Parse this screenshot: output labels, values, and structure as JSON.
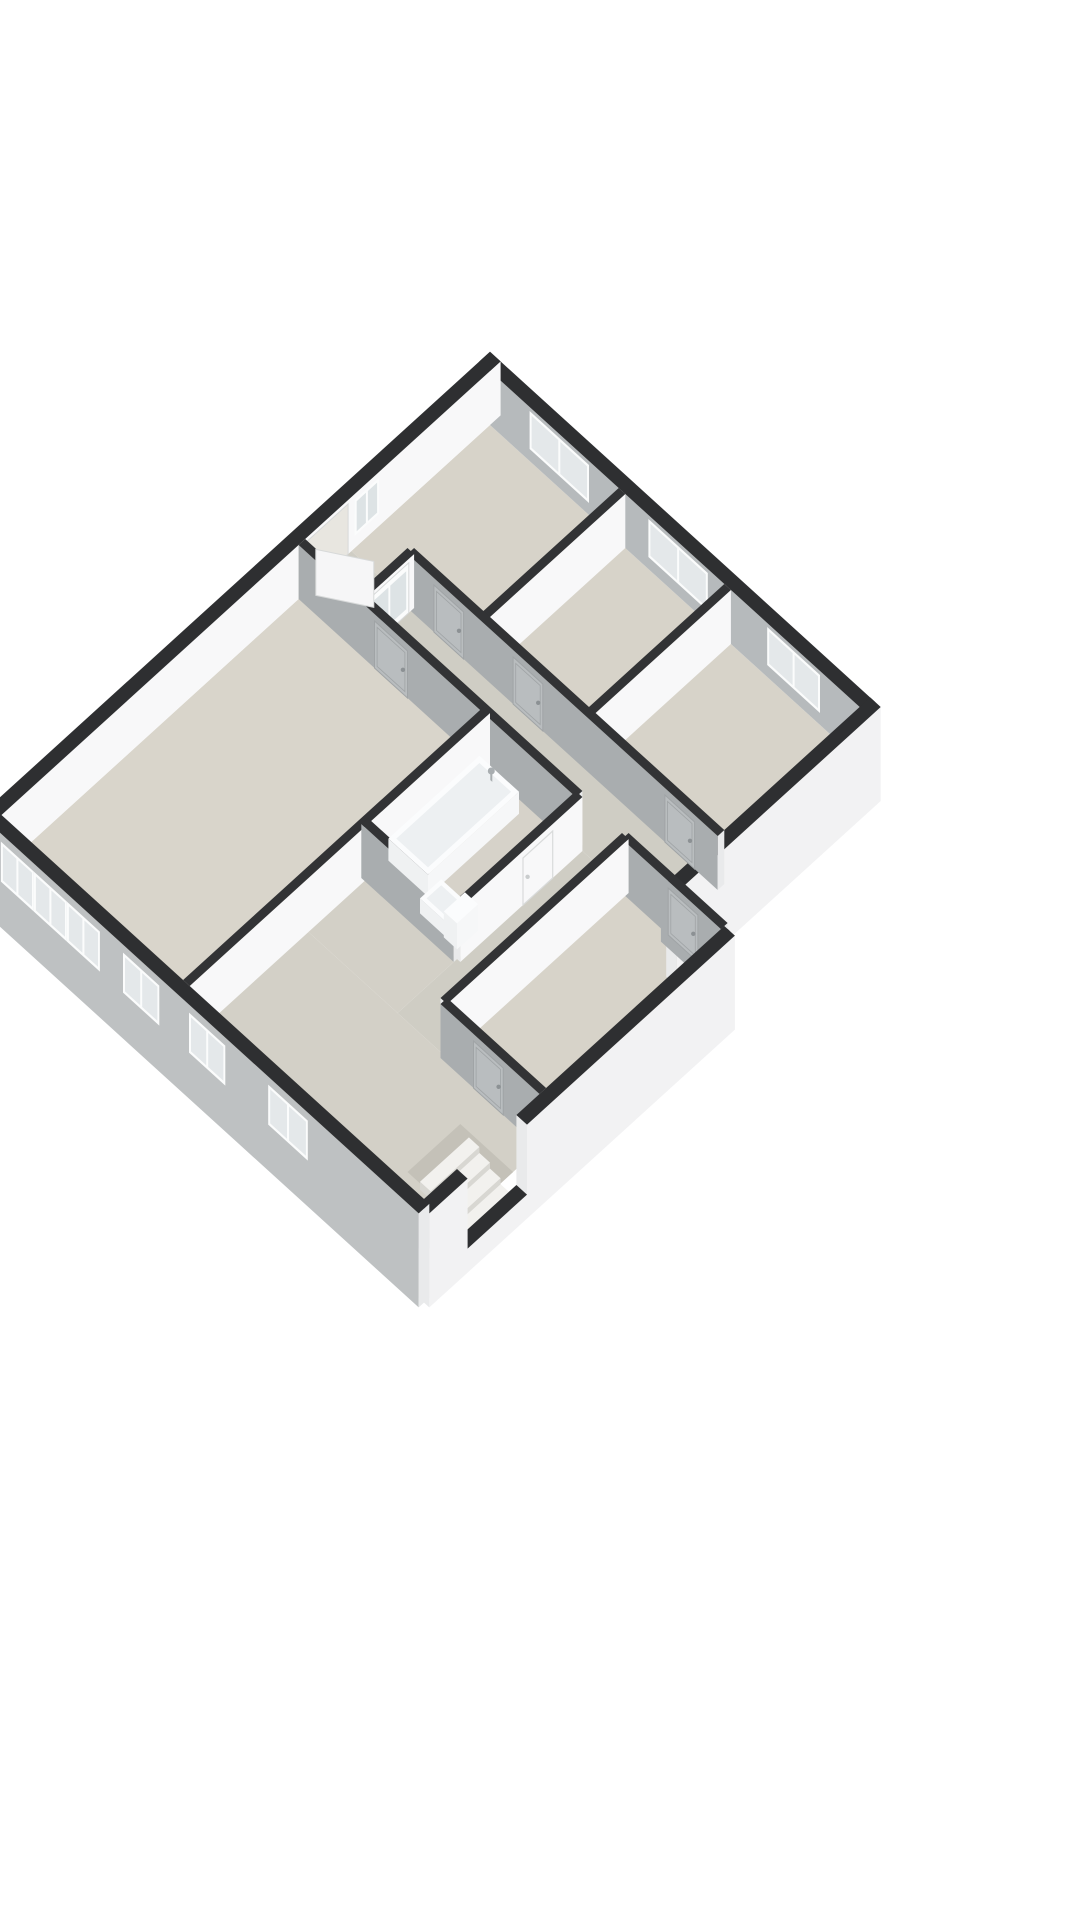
{
  "scene": {
    "proj": {
      "cx": 490,
      "cy": 425,
      "kx": 0.66,
      "ky": 0.6,
      "wallHeight": 54
    },
    "colors": {
      "bg": "#ffffff",
      "cap": "#2e2f31",
      "capInt": "#323335",
      "extWhite": "#f2f2f3",
      "extSW": "#bec1c2",
      "intWhite": "#f8f8f9",
      "intGray": "#b6babc",
      "intGrayDark": "#a9adaf",
      "endCap": "#e9eaeb",
      "floorRoom": "#d7d3c9",
      "floorLiving": "#d9d5cb",
      "floorCorridor": "#cfcdc4",
      "floorHall": "#d3d0c7",
      "floorBath": "#d6d2c9",
      "stairwell": "#c4c1b8",
      "tread": "#f2f1ee",
      "riser": "#d8d7d2",
      "frame": "#fbfcfc",
      "pane": "#e4e8ea",
      "paneDoor": "#dde3e5",
      "leaf": "#f6f6f7",
      "leafLine": "#d7d9d9",
      "outlineLine": "#d9dbdb",
      "doorGray": "#b9bdbf",
      "doorGrayLine": "#a0a4a6",
      "doorHandle": "#8c9194",
      "handleLight": "#c9cccd",
      "openingJamb": "#e8e6e0",
      "tubTop": "#fbfcfd",
      "tubBasin": "#edf0f2",
      "tubSide": "#eff1f2",
      "tubSideE": "#f6f7f8",
      "metal": "#a9aeb1"
    },
    "floors": [
      {
        "n": "bedroom-1-floor",
        "r": [
          0,
          0,
          200,
          210
        ],
        "c": "floorRoom"
      },
      {
        "n": "bedroom-2-floor",
        "r": [
          200,
          0,
          360,
          210
        ],
        "c": "floorRoom"
      },
      {
        "n": "bedroom-3-floor",
        "r": [
          360,
          0,
          560,
          210
        ],
        "c": "floorRoom"
      },
      {
        "n": "corridor-floor",
        "r": [
          0,
          210,
          560,
          285
        ],
        "c": "floorCorridor"
      },
      {
        "n": "corridor-2-floor",
        "r": [
          420,
          285,
          490,
          560
        ],
        "c": "floorCorridor"
      },
      {
        "n": "bathroom-floor",
        "r": [
          280,
          285,
          420,
          470
        ],
        "c": "floorBath"
      },
      {
        "n": "living-room-floor",
        "r": [
          0,
          285,
          280,
          740
        ],
        "c": "floorLiving"
      },
      {
        "n": "se-bedroom-floor",
        "r": [
          490,
          285,
          640,
          560
        ],
        "c": "floorRoom"
      },
      {
        "n": "hall-upper-floor",
        "r": [
          280,
          470,
          420,
          560
        ],
        "c": "floorHall"
      },
      {
        "n": "hall-floor",
        "r": [
          280,
          560,
          640,
          740
        ],
        "c": "floorHall"
      }
    ],
    "walls": [
      {
        "n": "exterior-wall-ne",
        "axis": "x",
        "at": -8,
        "f": -16,
        "t2": 568,
        "th": 16,
        "zb": 0,
        "c": "intGray",
        "capc": "cap",
        "feat": [
          {
            "k": "win",
            "a": 60,
            "b": 150,
            "s": 12,
            "t": 50
          },
          {
            "k": "win",
            "a": 240,
            "b": 330,
            "s": 12,
            "t": 50
          },
          {
            "k": "win",
            "a": 420,
            "b": 500,
            "s": 12,
            "t": 50
          }
        ]
      },
      {
        "n": "exterior-wall-nw",
        "axis": "y",
        "at": -8,
        "f": -16,
        "t2": 748,
        "th": 16,
        "zb": 0,
        "c": "intWhite",
        "capc": "cap",
        "feat": [
          {
            "k": "win",
            "a": 168,
            "b": 205,
            "s": 12,
            "t": 48,
            "pane": "paneDoor"
          },
          {
            "k": "opening",
            "a": 215,
            "b": 280
          }
        ]
      },
      {
        "n": "partition-bed1-bed2",
        "axis": "y",
        "at": 200,
        "f": 0,
        "t2": 210,
        "th": 10,
        "c": "intWhite",
        "capc": "capInt"
      },
      {
        "n": "partition-bed2-bed3",
        "axis": "y",
        "at": 360,
        "f": 0,
        "t2": 210,
        "th": 10,
        "c": "intWhite",
        "capc": "capInt"
      },
      {
        "n": "exterior-wall-se-upper",
        "axis": "y",
        "at": 568,
        "f": -16,
        "t2": 293,
        "th": 16,
        "zb": -40,
        "c": "extWhite",
        "capc": "cap"
      },
      {
        "n": "partition-corridor-north",
        "axis": "x",
        "at": 210,
        "f": 90,
        "t2": 560,
        "th": 10,
        "c": "intGrayDark",
        "capc": "capInt",
        "feat": [
          {
            "k": "door",
            "a": 130,
            "b": 175
          },
          {
            "k": "door",
            "a": 250,
            "b": 295
          },
          {
            "k": "door",
            "a": 480,
            "b": 525
          }
        ]
      },
      {
        "n": "exterior-wall-step",
        "axis": "x",
        "at": 293,
        "f": 560,
        "t2": 648,
        "th": 16,
        "zb": 0,
        "c": "intGrayDark",
        "capc": "cap"
      },
      {
        "n": "partition-vestibule",
        "axis": "y",
        "at": 90,
        "f": 210,
        "t2": 285,
        "th": 10,
        "c": "intWhite",
        "capc": "capInt",
        "feat": [
          {
            "k": "glass_door",
            "a": 218,
            "b": 277
          }
        ]
      },
      {
        "n": "partition-corridor-south",
        "axis": "x",
        "at": 285,
        "f": 0,
        "t2": 420,
        "th": 10,
        "c": "intGrayDark",
        "capc": "capInt",
        "feat": [
          {
            "k": "door",
            "a": 115,
            "b": 165
          }
        ]
      },
      {
        "n": "partition-sebed-north",
        "axis": "x",
        "at": 285,
        "f": 490,
        "t2": 640,
        "th": 10,
        "c": "intGrayDark",
        "capc": "capInt",
        "feat": [
          {
            "k": "door",
            "a": 560,
            "b": 605
          }
        ]
      },
      {
        "n": "partition-living-east",
        "axis": "y",
        "at": 280,
        "f": 285,
        "t2": 740,
        "th": 10,
        "c": "intWhite",
        "capc": "capInt"
      },
      {
        "n": "partition-bath-east",
        "axis": "y",
        "at": 420,
        "f": 285,
        "t2": 470,
        "th": 10,
        "c": "intWhite",
        "capc": "capInt",
        "feat": [
          {
            "k": "door_outline",
            "a": 330,
            "b": 375
          }
        ]
      },
      {
        "n": "partition-sebed-west",
        "axis": "y",
        "at": 490,
        "f": 285,
        "t2": 560,
        "th": 10,
        "c": "intWhite",
        "capc": "capInt"
      },
      {
        "n": "partition-bath-south",
        "axis": "x",
        "at": 470,
        "f": 280,
        "t2": 420,
        "th": 10,
        "c": "intGrayDark",
        "capc": "capInt"
      },
      {
        "n": "partition-sebed-south",
        "axis": "x",
        "at": 560,
        "f": 490,
        "t2": 640,
        "th": 10,
        "c": "intGrayDark",
        "capc": "capInt",
        "feat": [
          {
            "k": "door",
            "a": 540,
            "b": 585
          }
        ]
      },
      {
        "n": "exterior-wall-se-lower-a",
        "axis": "y",
        "at": 648,
        "f": 285,
        "t2": 600,
        "th": 16,
        "zb": -40,
        "c": "extWhite",
        "capc": "cap",
        "late": true
      },
      {
        "n": "exterior-wall-se-sill",
        "axis": "y",
        "at": 648,
        "f": 600,
        "t2": 690,
        "th": 16,
        "zb": -40,
        "h": -16,
        "c": "extWhite",
        "capc": "cap",
        "late": true
      },
      {
        "n": "exterior-wall-se-lower-b",
        "axis": "y",
        "at": 648,
        "f": 690,
        "t2": 748,
        "th": 16,
        "zb": -40,
        "c": "extWhite",
        "capc": "cap",
        "late": true
      },
      {
        "n": "exterior-wall-sw",
        "axis": "x",
        "at": 748,
        "f": -16,
        "t2": 648,
        "th": 16,
        "zb": -40,
        "c": "extSW",
        "capc": "cap",
        "late": true,
        "feat": [
          {
            "k": "win",
            "a": 15,
            "b": 65,
            "s": 6,
            "t": 46
          },
          {
            "k": "win",
            "a": 65,
            "b": 115,
            "s": 6,
            "t": 46
          },
          {
            "k": "win",
            "a": 115,
            "b": 165,
            "s": 6,
            "t": 46
          },
          {
            "k": "win",
            "a": 200,
            "b": 255,
            "s": 6,
            "t": 46
          },
          {
            "k": "win",
            "a": 300,
            "b": 355,
            "s": 6,
            "t": 46
          },
          {
            "k": "win",
            "a": 420,
            "b": 480,
            "s": 6,
            "t": 46
          }
        ]
      }
    ],
    "fixpolys": [
      {
        "n": "stairwell-opening",
        "r": [
          560,
          605,
          640,
          685
        ],
        "c": "stairwell"
      }
    ],
    "boxes": [
      {
        "n": "bathtub",
        "x0": 286,
        "y0": 302,
        "x1": 346,
        "y1": 440,
        "z0": 0,
        "z1": 22,
        "top": "tubTop",
        "s": "tubSide",
        "e": "tubSideE",
        "inner": 6,
        "innerC": "tubBasin"
      },
      {
        "n": "toilet-bowl",
        "x0": 354,
        "y0": 428,
        "x1": 392,
        "y1": 460,
        "z0": 0,
        "z1": 15,
        "top": "tubTop",
        "s": "tubSide",
        "e": "tubSideE",
        "inner": 5,
        "innerC": "tubBasin"
      },
      {
        "n": "toilet-tank",
        "x0": 392,
        "y0": 430,
        "x1": 412,
        "y1": 462,
        "z0": 0,
        "z1": 26,
        "top": "tubTop",
        "s": "tubSide",
        "e": "tubSideE"
      },
      {
        "n": "stair-tread-1",
        "x0": 576,
        "y0": 608,
        "x1": 592,
        "y1": 682,
        "z0": -10,
        "z1": -2,
        "top": "tread",
        "s": "riser",
        "e": "riser"
      },
      {
        "n": "stair-tread-2",
        "x0": 592,
        "y0": 608,
        "x1": 608,
        "y1": 682,
        "z0": -16,
        "z1": -8,
        "top": "tread",
        "s": "riser",
        "e": "riser"
      },
      {
        "n": "stair-tread-3",
        "x0": 608,
        "y0": 608,
        "x1": 624,
        "y1": 682,
        "z0": -22,
        "z1": -14,
        "top": "tread",
        "s": "riser",
        "e": "riser"
      },
      {
        "n": "stair-tread-4",
        "x0": 624,
        "y0": 608,
        "x1": 640,
        "y1": 682,
        "z0": -28,
        "z1": -20,
        "top": "tread",
        "s": "riser",
        "e": "riser"
      }
    ],
    "faucet": {
      "x": 316,
      "y": 314,
      "z": 22
    },
    "doorLeaf": {
      "hinge": [
        10,
        274
      ],
      "end": [
        64,
        240
      ],
      "h": 46
    }
  }
}
